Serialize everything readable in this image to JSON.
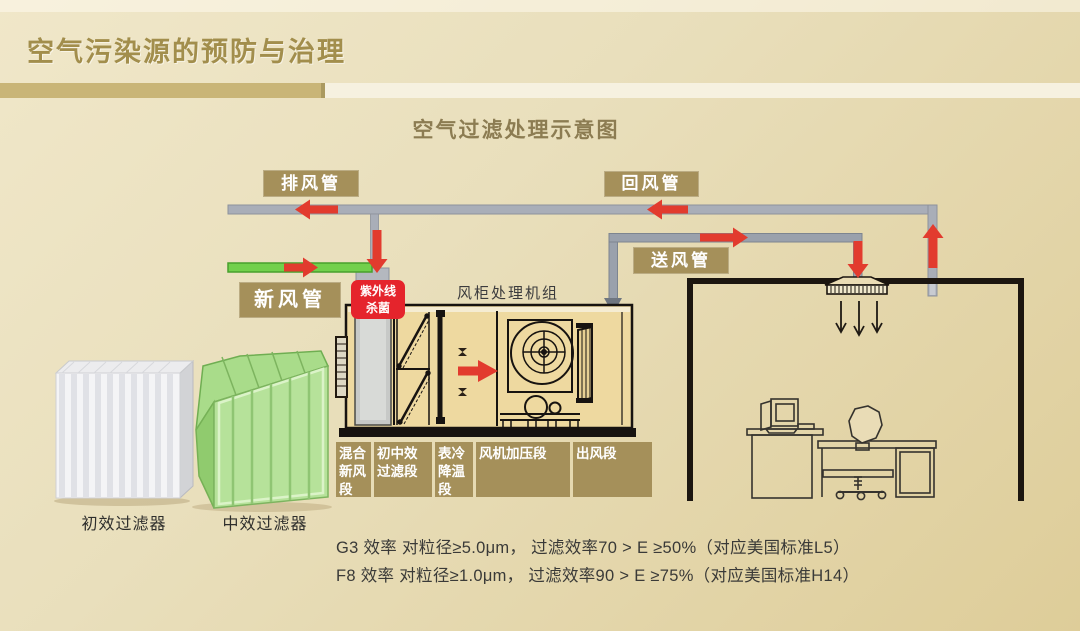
{
  "slide": {
    "title": "空气污染源的预防与治理",
    "subtitle": "空气过滤处理示意图"
  },
  "diagram": {
    "duct_labels": {
      "exhaust": "排风管",
      "return": "回风管",
      "fresh": "新风管",
      "supply": "送风管"
    },
    "uv_label": "紫外线 杀菌",
    "uv_line1": "紫外线",
    "uv_line2": "杀菌",
    "ahu_title": "风柜处理机组",
    "ahu_sections": [
      "混合新风段",
      "初中效过滤段",
      "表冷降温段",
      "风机加压段",
      "出风段"
    ],
    "filters": [
      {
        "caption": "初效过滤器"
      },
      {
        "caption": "中效过滤器"
      }
    ],
    "notes": [
      "G3 效率 对粒径≥5.0μm， 过滤效率70 > E ≥50%（对应美国标准L5）",
      "F8 效率 对粒径≥1.0μm， 过滤效率90 > E ≥75%（对应美国标准H14）"
    ],
    "colors": {
      "accent_gold": "#a5905a",
      "bar_gold": "#c9b577",
      "bar_cream": "#f6f1e0",
      "title_gold": "#a28e4c",
      "duct_gray": "#a9aeb8",
      "fresh_green": "#72d04c",
      "arrow_red": "#e23b2e",
      "uv_red": "#e5242c",
      "room_line": "#1c1610",
      "text_dark": "#3a3a3c"
    }
  }
}
